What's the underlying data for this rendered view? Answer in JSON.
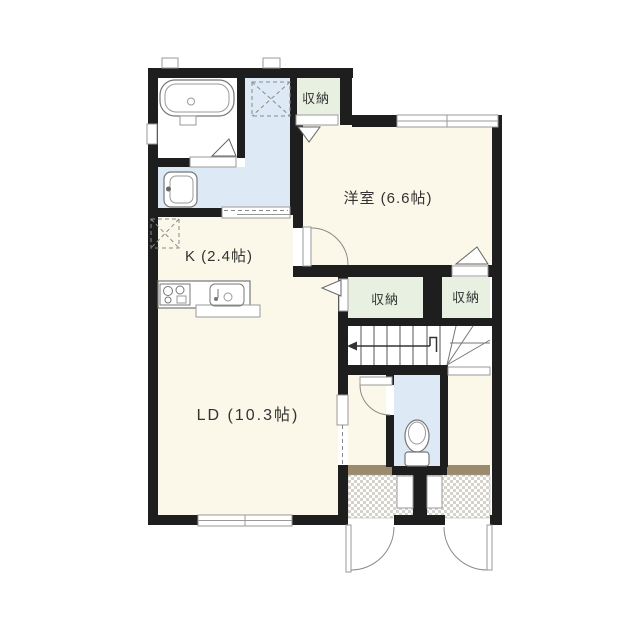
{
  "plan": {
    "rooms": {
      "western_room": {
        "label": "洋室 (6.6帖)"
      },
      "kitchen": {
        "label": "K (2.4帖)"
      },
      "living_dining": {
        "label": "LD (10.3帖)"
      },
      "closet_top": {
        "label": "収納"
      },
      "closet_left": {
        "label": "収納"
      },
      "closet_right": {
        "label": "収納"
      }
    }
  },
  "colors": {
    "wall": "#1e1e1e",
    "floor": "#fbf7e9",
    "wet_floor": "#dde9f4",
    "closet_floor": "#e8f1e1",
    "entry_step": "#9b8a6b",
    "entry_check": "#d6d3cc",
    "text": "#333333"
  }
}
